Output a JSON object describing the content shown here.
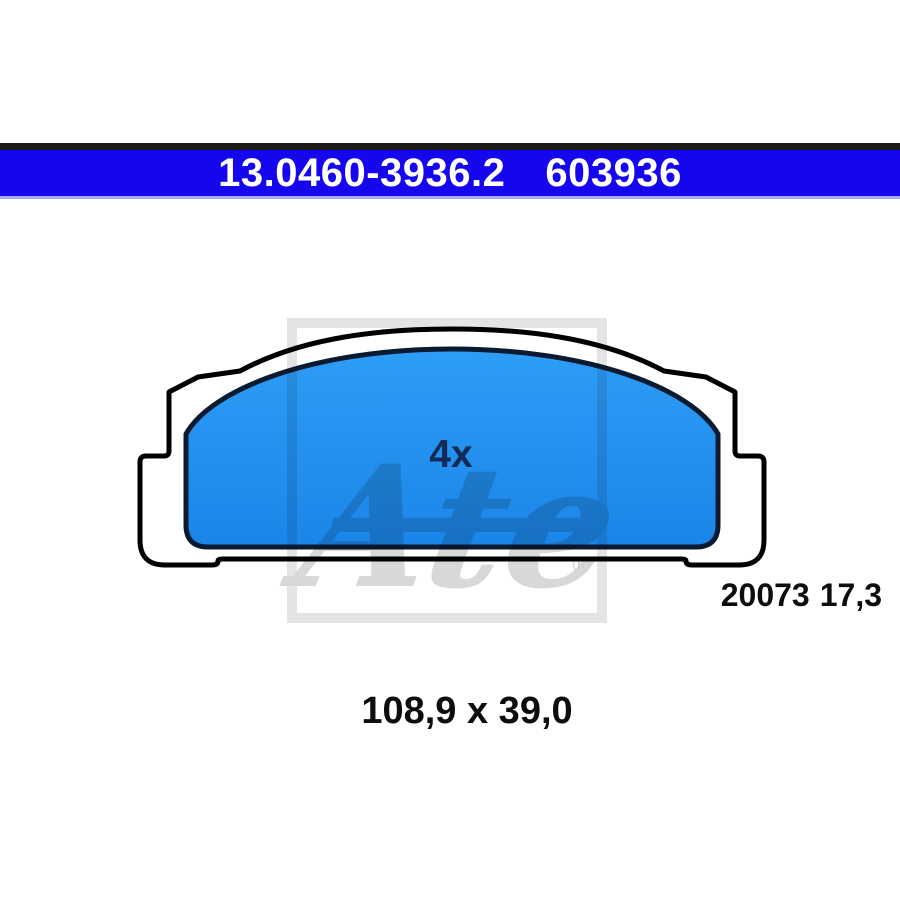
{
  "header": {
    "part_number": "13.0460-3936.2",
    "article_code": "603936",
    "bar_color": "#1606EE",
    "strip_color": "#1A1A1A",
    "text_color": "#FFFFFF"
  },
  "drawing": {
    "quantity_label": "4x",
    "quantity_label_color": "#122A55",
    "pad_fill_top": "#2E9DF6",
    "pad_fill_bottom": "#1A85E8",
    "outline_color": "#000000",
    "plate_fill": "#FFFFFF"
  },
  "labels": {
    "wva_number": "20073",
    "thickness": "17,3",
    "dimensions": "108,9 x 39,0"
  },
  "watermark": {
    "brand": "Ate",
    "registered": "®",
    "color": "#D8D8D8"
  }
}
